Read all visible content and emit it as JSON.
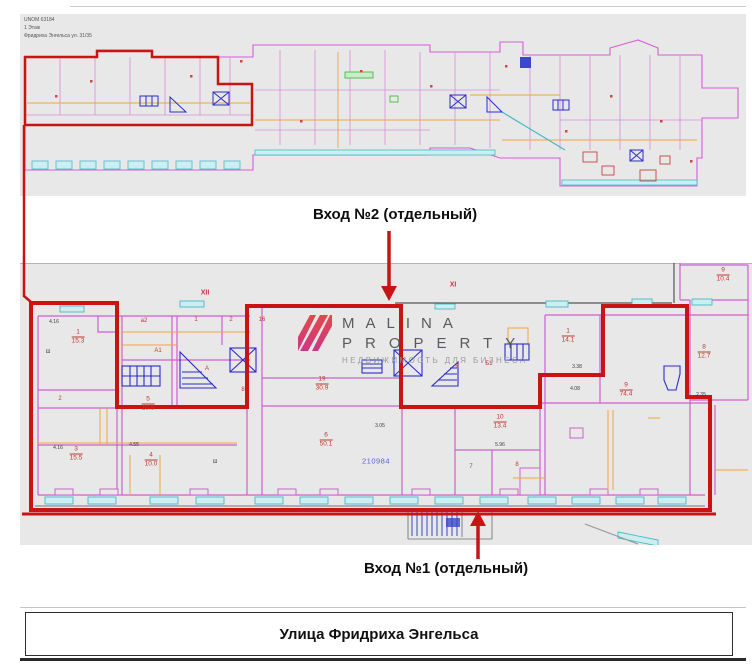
{
  "title_block": {
    "line1": "UNOM 63184",
    "line2": "1 Этаж",
    "line3": "Фридриха Энгельса ул. 31/35"
  },
  "annotations": {
    "entrance2": "Вход №2 (отдельный)",
    "entrance1": "Вход №1 (отдельный)",
    "street": "Улица Фридриха Энгельса"
  },
  "watermark": {
    "line1": "MALINA",
    "line2": "PROPERTY",
    "line3": "НЕДВИЖИМОСТЬ ДЛЯ БИЗНЕСА"
  },
  "colors": {
    "highlight_red": "#c81414",
    "wall_magenta": "#cf5fcf",
    "window_cyan": "#49b8c8",
    "fixture_blue": "#2b2bcf",
    "secondary_orange": "#f2a43c",
    "cadastral_blue": "#5560d8",
    "plan_bg": "#e8e8e8"
  },
  "detail_plan": {
    "zone_labels": [
      {
        "t": "XII",
        "x": 205,
        "y": 293
      },
      {
        "t": "XI",
        "x": 453,
        "y": 285
      }
    ],
    "room_labels": [
      {
        "num": "1",
        "area": "15.3",
        "x": 78,
        "y": 337
      },
      {
        "num": "3",
        "area": "15.5",
        "x": 76,
        "y": 454
      },
      {
        "num": "5",
        "area": "10.8",
        "x": 148,
        "y": 404
      },
      {
        "num": "4",
        "area": "10.0",
        "x": 151,
        "y": 460
      },
      {
        "num": "19",
        "area": "30.9",
        "x": 322,
        "y": 384
      },
      {
        "num": "6",
        "area": "50.1",
        "x": 326,
        "y": 440
      },
      {
        "num": "10",
        "area": "13.4",
        "x": 500,
        "y": 422
      },
      {
        "num": "1",
        "area": "14.1",
        "x": 568,
        "y": 336
      },
      {
        "num": "9",
        "area": "74.4",
        "x": 626,
        "y": 390
      },
      {
        "num": "8",
        "area": "12.7",
        "x": 704,
        "y": 352
      },
      {
        "num": "9",
        "area": "10.4",
        "x": 723,
        "y": 275
      }
    ],
    "simple_labels": [
      {
        "t": "2",
        "x": 60,
        "y": 399
      },
      {
        "t": "7",
        "x": 471,
        "y": 467
      },
      {
        "t": "8",
        "x": 517,
        "y": 465
      },
      {
        "t": "8",
        "x": 243,
        "y": 390
      },
      {
        "t": "а2",
        "x": 144,
        "y": 321
      },
      {
        "t": "1",
        "x": 196,
        "y": 320
      },
      {
        "t": "2",
        "x": 231,
        "y": 320
      },
      {
        "t": "16",
        "x": 262,
        "y": 320
      },
      {
        "t": "А1",
        "x": 158,
        "y": 351
      },
      {
        "t": "А",
        "x": 207,
        "y": 369
      },
      {
        "t": "Б1",
        "x": 489,
        "y": 364
      },
      {
        "t": "6",
        "x": 457,
        "y": 367
      }
    ],
    "dimensions": [
      {
        "t": "4.16",
        "x": 54,
        "y": 322
      },
      {
        "t": "4.16",
        "x": 58,
        "y": 448
      },
      {
        "t": "4.55",
        "x": 134,
        "y": 445
      },
      {
        "t": "3.05",
        "x": 380,
        "y": 426
      },
      {
        "t": "5.96",
        "x": 500,
        "y": 445
      },
      {
        "t": "3.38",
        "x": 577,
        "y": 367
      },
      {
        "t": "4.08",
        "x": 575,
        "y": 389
      },
      {
        "t": "2.35",
        "x": 701,
        "y": 395
      },
      {
        "t": "Ш",
        "x": 48,
        "y": 352
      },
      {
        "t": "Ш",
        "x": 215,
        "y": 462
      }
    ],
    "cadastral_label": {
      "t": "210984",
      "x": 376,
      "y": 461
    }
  }
}
